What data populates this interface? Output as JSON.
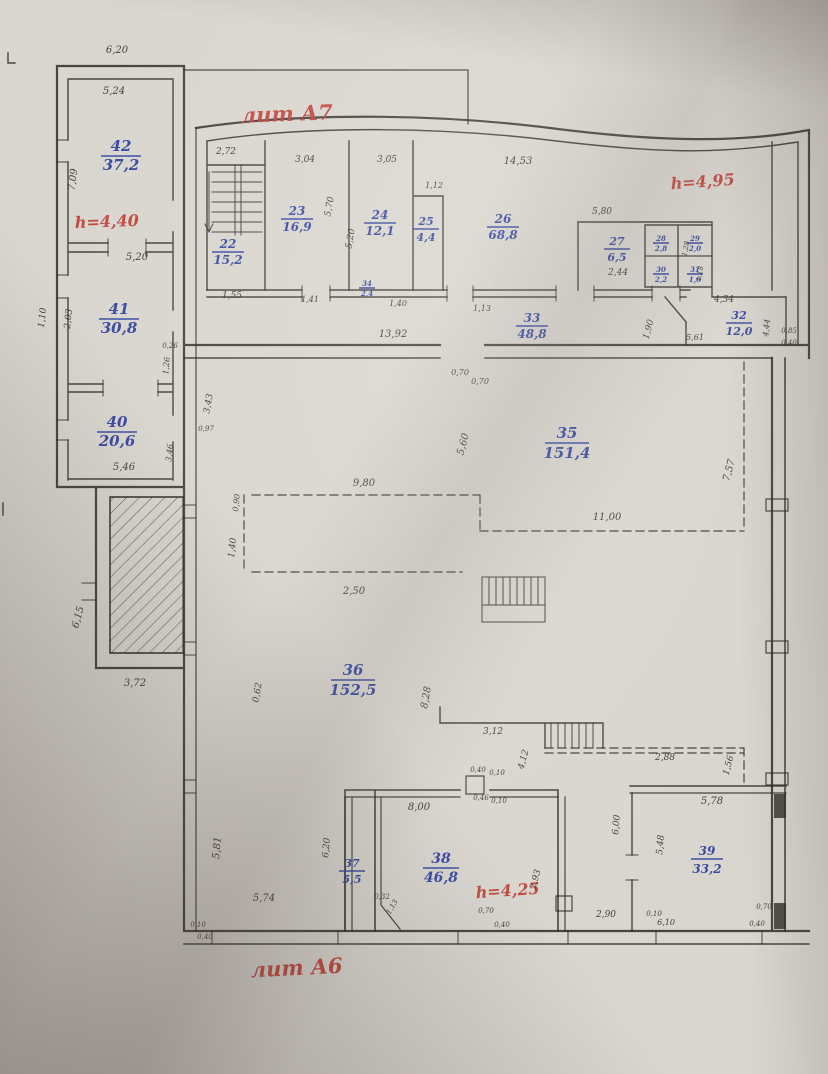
{
  "plan": {
    "annotations_red": {
      "lit_top": "лит А7",
      "lit_bottom": "лит А6",
      "h_main": "h=4,95",
      "h_left": "h=4,40",
      "h_bottom": "h=4,25"
    },
    "rooms": [
      {
        "num": "42",
        "area": "37,2"
      },
      {
        "num": "41",
        "area": "30,8"
      },
      {
        "num": "40",
        "area": "20,6"
      },
      {
        "num": "22",
        "area": "15,2"
      },
      {
        "num": "23",
        "area": "16,9"
      },
      {
        "num": "24",
        "area": "12,1"
      },
      {
        "num": "25",
        "area": "4,4"
      },
      {
        "num": "26",
        "area": "68,8"
      },
      {
        "num": "27",
        "area": "6,5"
      },
      {
        "num": "28",
        "area": "2,8"
      },
      {
        "num": "29",
        "area": "2,0"
      },
      {
        "num": "30",
        "area": "2,2"
      },
      {
        "num": "31",
        "area": "1,0"
      },
      {
        "num": "33",
        "area": "48,8"
      },
      {
        "num": "32",
        "area": "12,0"
      },
      {
        "num": "34",
        "area": "2,4"
      },
      {
        "num": "35",
        "area": "151,4"
      },
      {
        "num": "36",
        "area": "152,5"
      },
      {
        "num": "37",
        "area": "5,5"
      },
      {
        "num": "38",
        "area": "46,8"
      },
      {
        "num": "39",
        "area": "33,2"
      }
    ],
    "dims": [
      "6,20",
      "5,24",
      "7,09",
      "5,20",
      "1,10",
      "2,03",
      "0,26",
      "1,26",
      "5,46",
      "3,46",
      "6,15",
      "3,72",
      "3,43",
      "0,97",
      "2,72",
      "3,04",
      "3,05",
      "14,53",
      "1,12",
      "5,80",
      "5,70",
      "5,20",
      "2,44",
      "1,28",
      "1,18",
      "4,34",
      "1,90",
      "5,61",
      "13,92",
      "1,55",
      "1,41",
      "1,40",
      "1,13",
      "4,44",
      "0,85",
      "0,40",
      "0,70",
      "0,70",
      "5,60",
      "7,57",
      "9,80",
      "0,90",
      "11,00",
      "1,40",
      "2,50",
      "0,62",
      "8,28",
      "3,12",
      "4,12",
      "2,88",
      "1,56",
      "0,40",
      "0,10",
      "0,46",
      "0,10",
      "8,00",
      "6,20",
      "5,81",
      "5,74",
      "2,93",
      "0,70",
      "0,40",
      "2,90",
      "5,78",
      "6,00",
      "5,48",
      "0,10",
      "6,10",
      "0,70",
      "0,40",
      "0,10",
      "0,40",
      "1,13",
      "0,32"
    ],
    "colors": {
      "room_label": "#2b3f9e",
      "annotation": "#c04038",
      "ink": "#2e2a26",
      "paper": "#d9d5cf"
    }
  }
}
